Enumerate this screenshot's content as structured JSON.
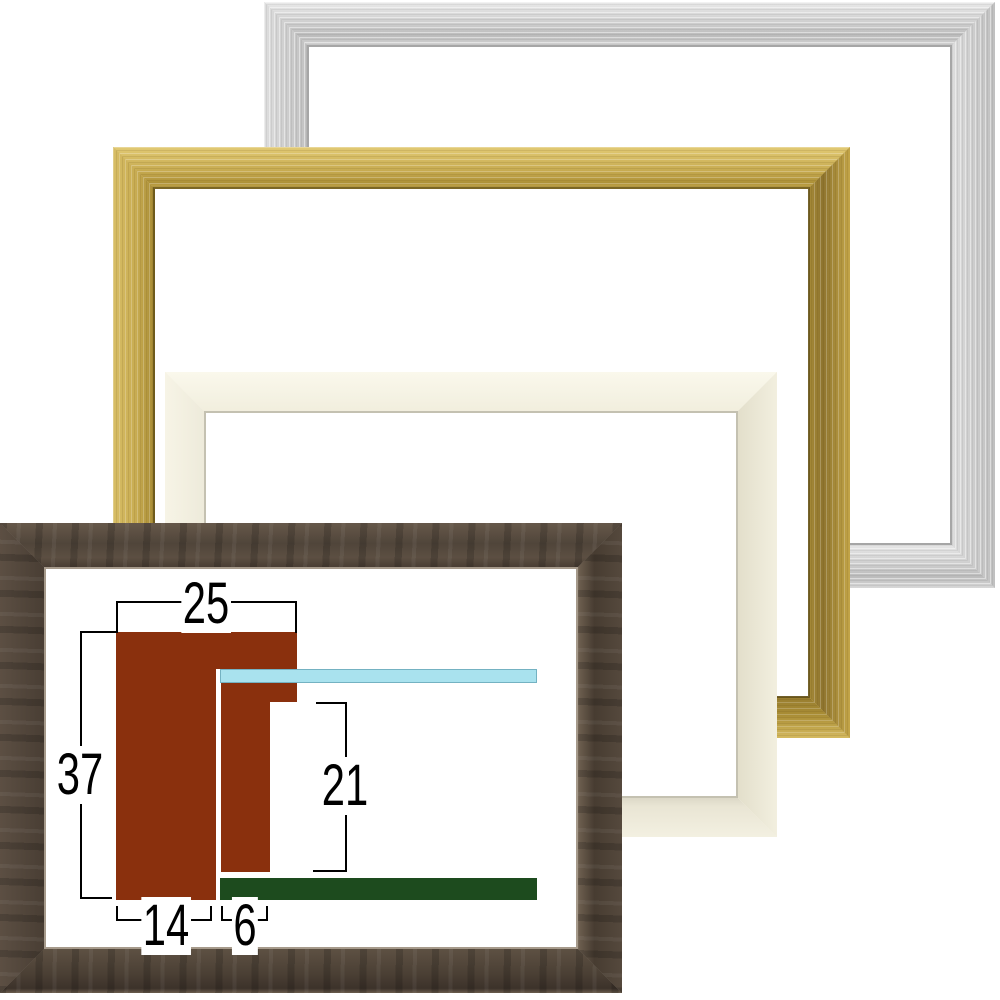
{
  "image_description": "Four empty picture frame mouldings stacked as cutout photos with a moulding cross-section dimension diagram",
  "colors": {
    "profile": "#8a300d",
    "glass": "#a9e2ee",
    "glassedge": "#74b2c2",
    "board": "#1d4b1e",
    "line": "#000000",
    "silver": "#cccccc",
    "gold": "#c8ac52",
    "cream": "#f5f2e3",
    "brown": "#564a3e"
  },
  "frames": [
    {
      "id": "silver",
      "name": "silver-frame"
    },
    {
      "id": "gold",
      "name": "gold-frame"
    },
    {
      "id": "cream",
      "name": "cream-white-frame"
    },
    {
      "id": "brown",
      "name": "dark-brown-frame"
    }
  ],
  "diagram": {
    "description": "frame moulding cross-section with dimensions in millimeters",
    "dimensions": {
      "face_width": {
        "value": "25"
      },
      "total_height": {
        "value": "37"
      },
      "inner_depth": {
        "value": "21"
      },
      "base_width": {
        "value": "14"
      },
      "lip_width": {
        "value": "6"
      }
    }
  }
}
